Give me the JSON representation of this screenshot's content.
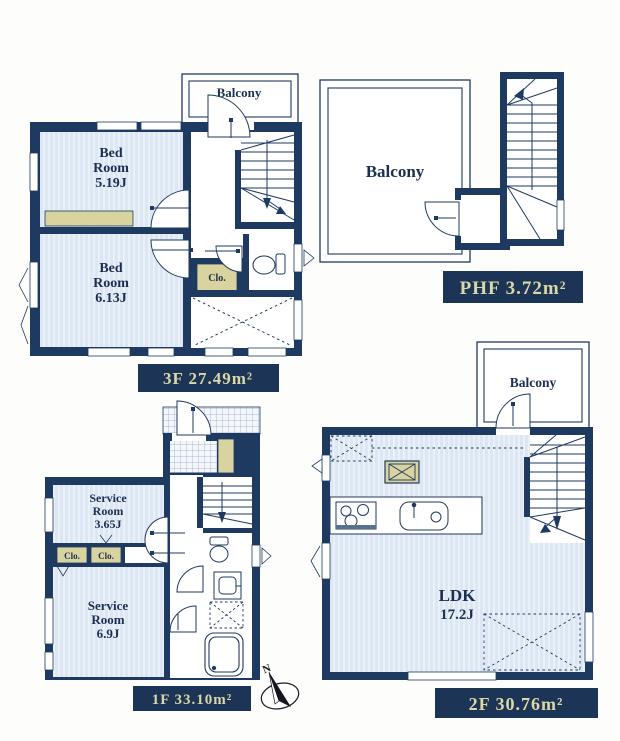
{
  "document_type": "floor-plan",
  "colors": {
    "wall_navy": "#1f3a60",
    "label_bg": "#1c3456",
    "label_text": "#d9d8a6",
    "room_fill": "#dce7f3",
    "room_stripe": "#e9f0f8",
    "closet_khaki": "#d9d3a0",
    "line_navy": "#1f3a60",
    "text_navy": "#1c2f52"
  },
  "floor_3f": {
    "balcony_label": "Balcony",
    "bedroom1": [
      "Bed",
      "Room",
      "5.19J"
    ],
    "bedroom2": [
      "Bed",
      "Room",
      "6.13J"
    ],
    "closet_label": "Clo.",
    "area_label": "3F 27.49m²"
  },
  "floor_phf": {
    "balcony_label": "Balcony",
    "area_label": "PHF 3.72m²"
  },
  "floor_1f": {
    "service_room1": [
      "Service",
      "Room",
      "3.65J"
    ],
    "service_room2": [
      "Service",
      "Room",
      "6.9J"
    ],
    "closet1_label": "Clo.",
    "closet2_label": "Clo.",
    "area_label": "1F 33.10m²"
  },
  "floor_2f": {
    "balcony_label": "Balcony",
    "ldk": [
      "LDK",
      "17.2J"
    ],
    "area_label": "2F 30.76m²"
  },
  "compass": {
    "north_label": "N"
  }
}
